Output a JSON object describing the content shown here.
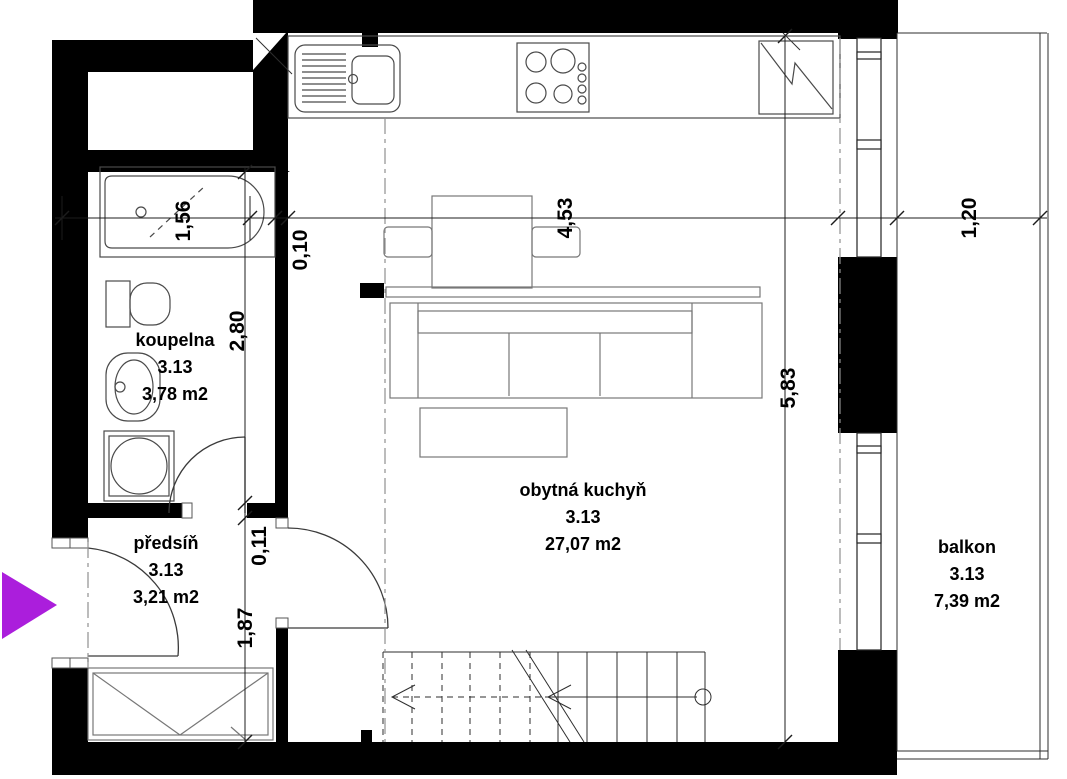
{
  "plan": {
    "title": "apartment floor plan",
    "rooms": [
      {
        "id": "koupelna",
        "name": "koupelna",
        "number": "3.13",
        "area": "3,78 m2"
      },
      {
        "id": "predsin",
        "name": "předsíň",
        "number": "3.13",
        "area": "3,21 m2"
      },
      {
        "id": "obytna-kuchyn",
        "name": "obytná kuchyň",
        "number": "3.13",
        "area": "27,07 m2"
      },
      {
        "id": "balkon",
        "name": "balkon",
        "number": "3.13",
        "area": "7,39 m2"
      }
    ],
    "dimensions": {
      "bath_width": "1,56",
      "wall_thickness": "0,10",
      "living_width": "4,53",
      "balcony_depth": "1,20",
      "bath_length": "2,80",
      "partition": "0,11",
      "hall_length": "1,87",
      "living_length": "5,83"
    },
    "colors": {
      "wall": "#000000",
      "entry_arrow": "#AB1EDC",
      "line": "#2e2e2e"
    },
    "icons": [
      "entry-arrow-icon",
      "bathtub",
      "toilet",
      "washbasin",
      "washing-machine",
      "kitchen-sink",
      "stove",
      "fridge",
      "dining-table",
      "chair",
      "tv",
      "sofa",
      "coffee-table",
      "stairs",
      "wardrobe",
      "window",
      "balcony-railing"
    ]
  }
}
